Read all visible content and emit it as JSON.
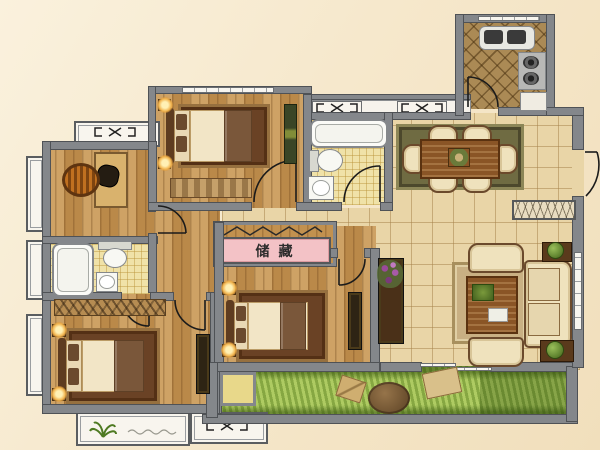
{
  "plan": {
    "storage_label": "储藏",
    "palette": {
      "background": "#f6e8cc",
      "wall": "#84878b",
      "wood_floor": "#c2914f",
      "tile_floor": "#e9d5a7",
      "bathroom_floor": "#f0e2a8",
      "kitchen_floor": "#ab8a55",
      "balcony_grass": "#a9c65b",
      "storage_label_bg": "#f3c2c6",
      "door_swing_line": "#1b1b1b",
      "window_box": "#f8f5ee"
    }
  }
}
